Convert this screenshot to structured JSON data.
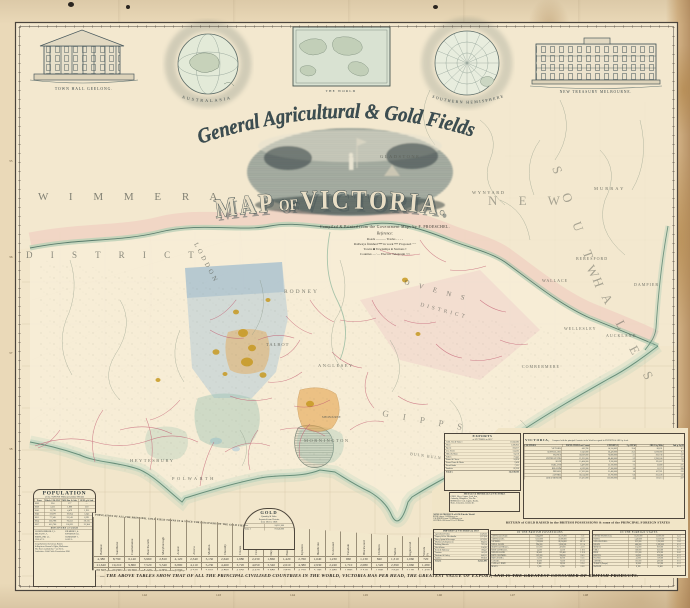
{
  "colors": {
    "paper": "#ead9b8",
    "ink": "#2f3a3c",
    "county_pink": "#c25d72",
    "gold": "#c89a22",
    "wash_blue": "#9fc0d6",
    "wash_teal": "#93bfae",
    "wash_orange": "#e6a44e",
    "coast_green": "#5d8671"
  },
  "insets": {
    "townhall_caption": "TOWN HALL GEELONG.",
    "treasury_caption": "NEW TREASURY MELBOURNE.",
    "globe_left_caption": "AUSTRALASIA",
    "globe_right_caption": "SOUTHERN HEMISPHERE",
    "world_caption": "THE WORLD"
  },
  "title": {
    "script_line": "General Agricultural & Gold Fields,",
    "map_word1": "MAP",
    "map_word2": " OF ",
    "map_word3": "VICTORIA.",
    "credit": "Compiled & Printed from the Government Maps by F. PROESCHEL."
  },
  "legend": {
    "heading": "Reference:",
    "lines": [
      "Roads ———   Tracks - - - -",
      "Railways finished ━━  in work ╍╍  Proposed ┄┄",
      "Towns ■   Townships ●   Stations ▪",
      "Counties —·—   Electric Telegraph ⌁⌁"
    ]
  },
  "frame": {
    "lon_labels": [
      "142",
      "143",
      "144",
      "145",
      "146",
      "147",
      "148"
    ],
    "lat_labels": [
      "35",
      "36",
      "37",
      "38"
    ]
  },
  "map": {
    "labels": [
      {
        "t": "W I M M E R A",
        "x": 38,
        "y": 200,
        "s": 11,
        "ls": 9,
        "r": 0,
        "o": 0.75
      },
      {
        "t": "D I S T R I C T",
        "x": 26,
        "y": 258,
        "s": 9,
        "ls": 8,
        "r": 0,
        "o": 0.7
      },
      {
        "t": "LODDON",
        "x": 194,
        "y": 244,
        "s": 6.5,
        "ls": 3,
        "r": 62,
        "o": 0.75
      },
      {
        "t": "RODNEY",
        "x": 284,
        "y": 293,
        "s": 5.5,
        "ls": 2,
        "r": 0,
        "o": 0.8
      },
      {
        "t": "N E W",
        "x": 488,
        "y": 205,
        "s": 13,
        "ls": 9,
        "r": 0,
        "o": 0.5
      },
      {
        "t": "S O U T H",
        "x": 552,
        "y": 168,
        "s": 13,
        "ls": 9,
        "r": 70,
        "o": 0.5
      },
      {
        "t": "W A L E S",
        "x": 586,
        "y": 268,
        "s": 13,
        "ls": 9,
        "r": 62,
        "o": 0.5
      },
      {
        "t": "GLADSTONE",
        "x": 380,
        "y": 158,
        "s": 4.5,
        "ls": 1.5,
        "r": 0,
        "o": 0.85
      },
      {
        "t": "WYNYARD",
        "x": 472,
        "y": 194,
        "s": 4.5,
        "ls": 1.5,
        "r": 0,
        "o": 0.85
      },
      {
        "t": "MURRAY",
        "x": 594,
        "y": 190,
        "s": 4.5,
        "ls": 2,
        "r": 0,
        "o": 0.85
      },
      {
        "t": "BERESFORD",
        "x": 576,
        "y": 260,
        "s": 4,
        "ls": 1,
        "r": 0,
        "o": 0.85
      },
      {
        "t": "DAMPIER",
        "x": 634,
        "y": 286,
        "s": 4,
        "ls": 1,
        "r": 0,
        "o": 0.85
      },
      {
        "t": "WALLACE",
        "x": 542,
        "y": 282,
        "s": 4,
        "ls": 1,
        "r": 0,
        "o": 0.85
      },
      {
        "t": "WELLESLEY",
        "x": 564,
        "y": 330,
        "s": 4,
        "ls": 1,
        "r": 0,
        "o": 0.85
      },
      {
        "t": "AUCKLAND",
        "x": 606,
        "y": 337,
        "s": 4,
        "ls": 1,
        "r": 0,
        "o": 0.85
      },
      {
        "t": "COMBERMERE",
        "x": 522,
        "y": 368,
        "s": 4,
        "ls": 1,
        "r": 0,
        "o": 0.85
      },
      {
        "t": "O V E N S",
        "x": 404,
        "y": 284,
        "s": 7,
        "ls": 4,
        "r": 15,
        "o": 0.7
      },
      {
        "t": "DISTRICT",
        "x": 420,
        "y": 306,
        "s": 5.5,
        "ls": 3,
        "r": 15,
        "o": 0.7
      },
      {
        "t": "ANGLESEY",
        "x": 318,
        "y": 367,
        "s": 4.5,
        "ls": 1.5,
        "r": 0,
        "o": 0.85
      },
      {
        "t": "MORNINGTON",
        "x": 304,
        "y": 442,
        "s": 4.5,
        "ls": 1.5,
        "r": 0,
        "o": 0.85
      },
      {
        "t": "G I P P S",
        "x": 382,
        "y": 416,
        "s": 9,
        "ls": 6,
        "r": 10,
        "o": 0.6
      },
      {
        "t": "L A N D",
        "x": 458,
        "y": 442,
        "s": 9,
        "ls": 6,
        "r": 10,
        "o": 0.6
      },
      {
        "t": "HEYTESBURY",
        "x": 130,
        "y": 462,
        "s": 4.5,
        "ls": 1.5,
        "r": 0,
        "o": 0.85
      },
      {
        "t": "POLWARTH",
        "x": 172,
        "y": 480,
        "s": 4.5,
        "ls": 2.5,
        "r": 0,
        "o": 0.85
      },
      {
        "t": "TALBOT",
        "x": 266,
        "y": 346,
        "s": 4.5,
        "ls": 1,
        "r": 0,
        "o": 0.85
      },
      {
        "t": "MELBOURNE",
        "x": 322,
        "y": 418,
        "s": 3,
        "ls": 0,
        "r": 0,
        "o": 0.9
      },
      {
        "t": "BULN BULN",
        "x": 410,
        "y": 455,
        "s": 4,
        "ls": 1,
        "r": 8,
        "o": 0.8
      }
    ]
  },
  "population_box": {
    "title": "POPULATION",
    "subtitle": "of the TOWNS Without GOLD FIELD",
    "col_headers": [
      "Years",
      "Whole COLONY",
      "MELBne & Sub.",
      "GEELg & Sub."
    ],
    "rows": [
      [
        "1836",
        "224",
        "177",
        "—"
      ],
      [
        "1838",
        "3,511",
        "1,800",
        "250"
      ],
      [
        "1841",
        "11,738",
        "4,479",
        "1,911"
      ],
      [
        "1846",
        "32,879",
        "10,954",
        "5,245"
      ],
      [
        "1851",
        "77,345",
        "23,143",
        "8,291"
      ],
      [
        "1854",
        "236,798",
        "76,553",
        "20,115"
      ],
      [
        "1857",
        "410,766",
        "100,321",
        "23,364"
      ]
    ],
    "divider": "DISCOVERY of GOLD",
    "side_rows": [
      "WARRNAMBOOL 2,3..",
      "BELFAST 1,7..",
      "PORTLAND 1,5..",
      "COLAC 9..",
      "KILMORE 1,4..",
      "KYNETON 1,8..",
      "HAMILTON 7..",
      "SALE 5.."
    ],
    "notes": [
      "Compiled from the Census Returns",
      "& Registrar General's Office, Melbourne.",
      "The Towns marked thus * are Ports.",
      "Authorities: Gold Fields Commission 1858."
    ]
  },
  "gold_box": {
    "title": "GOLD",
    "lines": [
      "Quantity & Value",
      "Exported from Victoria",
      "from 1851 to 1858"
    ],
    "rows": [
      [
        "Ozs.",
        "24,312,000"
      ],
      [
        "Value £",
        "97,248,000"
      ]
    ]
  },
  "goldfields": {
    "header": "POPULATION OF ALL THE PRINCIPAL GOLD FIELD TOWNS IN & SINCE THE DISCOVERY OF THE GOLD FIELDS IN VICTORIA",
    "row_labels": [
      "Towns",
      "1854",
      "1857",
      "1858"
    ],
    "towns": [
      "Ballarat",
      "Sandhurst",
      "Castlemaine",
      "Beechworth",
      "Maryborough",
      "Ararat",
      "Avoca",
      "Maldon",
      "Dunolly",
      "Clunes",
      "Creswick",
      "Daylesford",
      "Buninyong",
      "Kyneton",
      "Heathcote",
      "St Arnaud",
      "Taradale",
      "Blackwood",
      "Chiltern",
      "Talbot",
      "Inglewood",
      "Woods Pt"
    ],
    "r1854": [
      "4,380",
      "8,790",
      "6,140",
      "3,960",
      "2,810",
      "4,120",
      "2,340",
      "3,150",
      "2,640",
      "1,980",
      "2,230",
      "1,860",
      "1,420",
      "2,760",
      "1,640",
      "1,230",
      "960",
      "1,130",
      "840",
      "1,310",
      "1,060",
      "720"
    ],
    "r1857": [
      "21,640",
      "19,210",
      "9,860",
      "7,520",
      "5,340",
      "6,890",
      "4,110",
      "5,230",
      "4,460",
      "3,720",
      "4,050",
      "3,340",
      "2,610",
      "4,380",
      "2,930",
      "2,240",
      "1,710",
      "2,080",
      "1,520",
      "2,390",
      "1,960",
      "1,280"
    ],
    "r1858": [
      "23,100",
      "20,600",
      "10,400",
      "8,140",
      "5,900",
      "7,230",
      "4,520",
      "5,610",
      "4,890",
      "4,050",
      "4,420",
      "3,680",
      "2,870",
      "4,720",
      "3,190",
      "2,480",
      "1,890",
      "2,310",
      "1,690",
      "2,640",
      "2,170",
      "1,430"
    ],
    "note": "N.B. The Population of the Gold Field Towns is taken with the adjacent & surrounding Diggings."
  },
  "banner": {
    "text": "— THE ABOVE TABLES SHOW THAT OF ALL THE PRINCIPAL CIVILISED COUNTRIES IN THE WORLD, VICTORIA HAS PER HEAD, THE GREATEST VALUE OF EXPORT, AND IS THE GREATEST CONSUMER OF BRITISH PRODUCTS."
  },
  "exports_table": {
    "title": "EXPORTS",
    "subtitle": "of VICTORIA in 1857",
    "rows": [
      [
        "Gold, Ozs & Value £",
        "11,943,383"
      ],
      [
        "Wool",
        "1,586,953"
      ],
      [
        "Specie",
        "594,217"
      ],
      [
        "Live Stock",
        "134,562"
      ],
      [
        "Hides & Skins",
        "94,118"
      ],
      [
        "Tallow",
        "73,445"
      ],
      [
        "Butter & Cheese",
        "24,610"
      ],
      [
        "Bones Horns & Hoofs",
        "9,438"
      ],
      [
        "Bread Stuffs",
        "7,521"
      ],
      [
        "Sundries",
        "82,356"
      ]
    ],
    "total": [
      "Total £",
      "14,550,603"
    ]
  },
  "victoria_table": {
    "title": "VICTORIA,",
    "subtitle": "Compared with the principal Countries in the World as regards its EXPORTS & AREA p. head.",
    "col_headers": [
      "COUNTRIES",
      "POPULATION Last Census",
      "EXPORTS £",
      "£ p. HEAD",
      "AREA Sq. Miles",
      "Inh. p. Sq.M."
    ],
    "rows": [
      [
        "VICTORIA",
        "410,766",
        "14,550,603",
        "35.4",
        "86,831",
        "4.7"
      ],
      [
        "AUSTRALASIA",
        "1,042,000",
        "26,420,000",
        "25.3",
        "3,078,000",
        "0.3"
      ],
      [
        "FRANCE",
        "36,039,000",
        "76,800,000",
        "2.1",
        "203,736",
        "177"
      ],
      [
        "UNITED STATES",
        "23,191,000",
        "68,400,000",
        "2.9",
        "2,936,166",
        "7.9"
      ],
      [
        "SPAIN",
        "15,464,000",
        "9,200,000",
        "0.6",
        "195,607",
        "79"
      ],
      [
        "HOLLAND",
        "3,487,000",
        "25,100,000",
        "7.2",
        "12,680",
        "275"
      ],
      [
        "BELGIUM",
        "4,529,000",
        "17,300,000",
        "3.8",
        "11,373",
        "398"
      ],
      [
        "PRUSSIA",
        "17,202,000",
        "31,400,000",
        "1.8",
        "107,921",
        "159"
      ],
      [
        "AUSTRIA",
        "36,514,000",
        "22,700,000",
        "0.6",
        "255,226",
        "143"
      ],
      [
        "GREAT BRITAIN",
        "27,475,000",
        "122,000,000",
        "4.4",
        "121,115",
        "227"
      ]
    ]
  },
  "return_tables": {
    "header": "RETURN of GOLD RAISED in the BRITISH POSSESSIONS & some of the PRINCIPAL FOREIGN STATES",
    "left_title": "IN THE BRITISH POSSESSIONS",
    "right_title": "IN THE FOREIGN STATES",
    "left_rows": [
      [
        "AUSTRALIA (Total)",
        "8,644,000",
        "33,575,000",
        "£ s d"
      ],
      [
        "AUSTRALASIA",
        "8,212,000",
        "31,890,000",
        "4 2 6"
      ],
      [
        "VICTORIA",
        "7,218,000",
        "28,034,000",
        "68 5 0"
      ],
      [
        "NEW S. WALES",
        "994,000",
        "3,856,000",
        "11 2 4"
      ],
      [
        "SOUTH AUSTRALIA",
        "121,000",
        "470,000",
        "4 1 8"
      ],
      [
        "WEST AUSTRALIA",
        "14,200",
        "55,100",
        "3 18 2"
      ],
      [
        "NEW ZEALAND",
        "86,400",
        "335,400",
        "5 12 6"
      ],
      [
        "BRIT. COLUMBIA",
        "102,000",
        "396,000",
        "8 4 0"
      ],
      [
        "NOVA SCOTIA",
        "21,300",
        "82,700",
        "0 5 6"
      ],
      [
        "CANADA",
        "18,600",
        "72,200",
        "0 0 11"
      ],
      [
        "CAPE of G. HOPE",
        "9,400",
        "36,500",
        "0 2 4"
      ],
      [
        "MALTA",
        "1,200",
        "4,700",
        "0 0 8"
      ]
    ],
    "right_rows": [
      [
        "UNITED STATES (Cal.)",
        "13,212,000",
        "51,300,000",
        "2 4 2"
      ],
      [
        "RUSSIA",
        "5,420,000",
        "21,050,000",
        "0 6 4"
      ],
      [
        "NEW GRANADA",
        "812,000",
        "3,150,000",
        "1 8 6"
      ],
      [
        "BRAZIL",
        "486,000",
        "1,890,000",
        "0 5 2"
      ],
      [
        "MEXICO",
        "214,000",
        "830,000",
        "0 2 1"
      ],
      [
        "CHILI",
        "168,000",
        "652,000",
        "0 8 9"
      ],
      [
        "PERU",
        "121,000",
        "470,000",
        "0 4 6"
      ],
      [
        "BOLIVIA",
        "84,000",
        "326,000",
        "0 3 2"
      ],
      [
        "FRANCE",
        "41,000",
        "159,000",
        "0 0 1"
      ],
      [
        "AUSTRIA",
        "103,000",
        "400,000",
        "0 0 3"
      ],
      [
        "TURKEY (Europe)",
        "26,000",
        "101,000",
        "0 0 2"
      ],
      [
        "SWEDEN",
        "8,100",
        "31,400",
        "0 0 1"
      ]
    ]
  },
  "metals_note": {
    "title": "METALS & MINERALS of VICTORIA",
    "lines": [
      "GOLD, Silver, Copper, Lead, Iron,",
      "Antimony, Manganese, Zinc &c.",
      "MINERALS: Coal, Lignite, Kaolin,",
      "Slates, Limestone, Granite &c."
    ]
  },
  "produce_note": {
    "title": "ANNUAL PRODUCE of GOLD in the World",
    "lines": [
      "RUSSIA above £4 Millions p. an.",
      "CALIFORNIA from £10 Millions p. an.",
      "AUSTRALASIA from £11 to 12 Millions"
    ]
  },
  "imports_table": {
    "title": "IMPORTS of VICTORIA in 1857",
    "rows": [
      [
        "Agricultural Produce",
        "3,149,562"
      ],
      [
        "Drapery & Gen. Merchandise",
        "5,237,808"
      ],
      [
        "Wines, Spirits & Beverages",
        "1,373,925"
      ],
      [
        "Machinery & Implements",
        "864,233"
      ],
      [
        "Building Materials",
        "792,154"
      ],
      [
        "Oils & Paints",
        "214,381"
      ],
      [
        "Books & Stationery",
        "186,447"
      ],
      [
        "Furniture",
        "163,209"
      ],
      [
        "Hardware & Cutlery",
        "648,322"
      ],
      [
        "Sundries",
        "992,850"
      ]
    ],
    "total": [
      "Total £",
      "15,622,891"
    ]
  }
}
